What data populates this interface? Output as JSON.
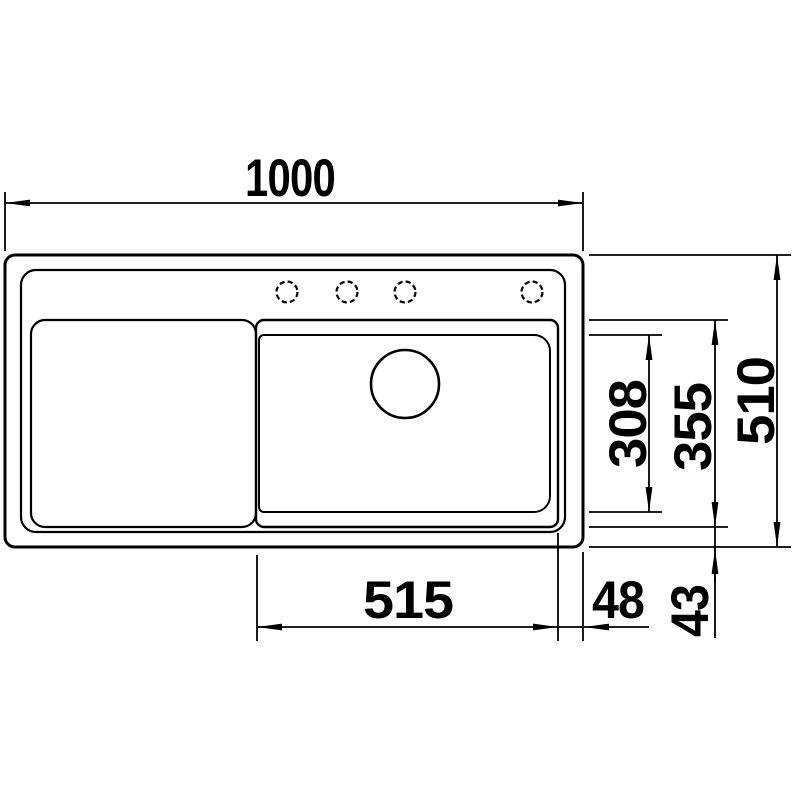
{
  "drawing": {
    "kind": "sink-top-view-dimension-drawing",
    "units": "mm"
  },
  "dims": {
    "overall_width": "1000",
    "overall_depth": "510",
    "bowl_width": "515",
    "bowl_right_offset": "48",
    "bowl_bottom_offset": "43",
    "bowl_inner_depth": "308",
    "bowl_outer_depth": "355"
  },
  "colors": {
    "line": "#000000",
    "background": "#ffffff"
  }
}
